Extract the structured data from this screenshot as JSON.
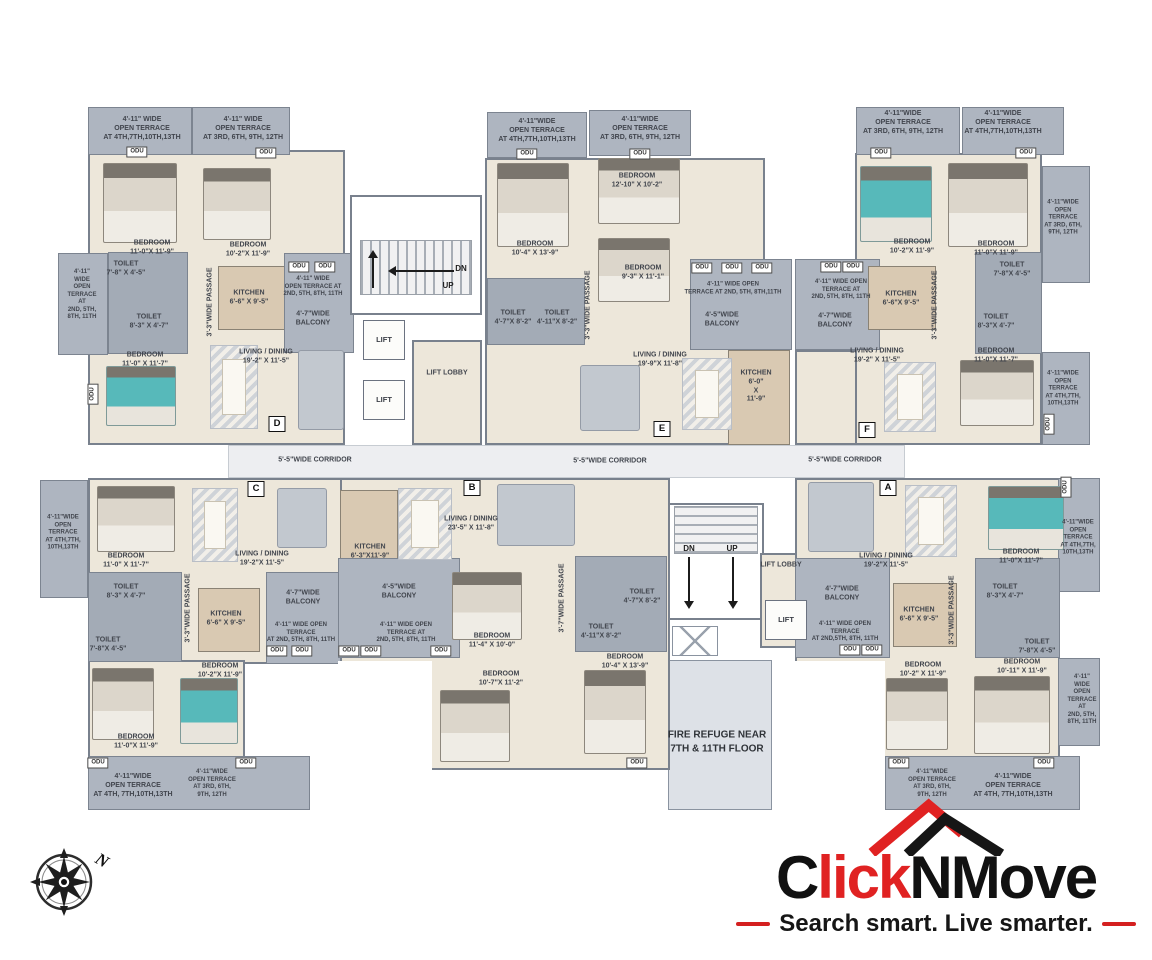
{
  "brand": {
    "part1": "C",
    "part2": "lick",
    "part3": "NMove",
    "tagline": "Search smart. Live smarter.",
    "accent_red": "#e02222",
    "ink_black": "#161616"
  },
  "compass": {
    "north_label": "N"
  },
  "plan": {
    "units": [
      "A",
      "B",
      "C",
      "D",
      "E",
      "F"
    ],
    "labels": [
      {
        "t": "4'-11\" WIDE\nOPEN TERRACE\nAT 4TH,7TH,10TH,13TH",
        "x": 142,
        "y": 129
      },
      {
        "t": "4'-11\" WIDE\nOPEN TERRACE\nAT 3RD, 6TH, 9TH, 12TH",
        "x": 243,
        "y": 129
      },
      {
        "t": "ODU",
        "x": 137,
        "y": 152,
        "c": "odu",
        "n": "odu-label"
      },
      {
        "t": "ODU",
        "x": 266,
        "y": 153,
        "c": "odu",
        "n": "odu-label"
      },
      {
        "t": "BEDROOM\n11'-0\"X 11'-9\"",
        "x": 152,
        "y": 248
      },
      {
        "t": "BEDROOM\n10'-2\"X 11'-9\"",
        "x": 248,
        "y": 250
      },
      {
        "t": "4'-11\"\nWIDE\nOPEN\nTERRACE\nAT\n2ND, 5TH,\n8TH, 11TH",
        "x": 82,
        "y": 295,
        "s": 6
      },
      {
        "t": "TOILET\n7'-8\" X 4'-5\"",
        "x": 126,
        "y": 269
      },
      {
        "t": "TOILET\n8'-3\" X 4'-7\"",
        "x": 149,
        "y": 322
      },
      {
        "t": "KITCHEN\n6'-6\" X 9'-5\"",
        "x": 249,
        "y": 298
      },
      {
        "t": "3'-3\"WIDE PASSAGE",
        "x": 211,
        "y": 302,
        "r": -90
      },
      {
        "t": "ODU",
        "x": 299,
        "y": 267,
        "c": "odu",
        "n": "odu-label"
      },
      {
        "t": "ODU",
        "x": 325,
        "y": 267,
        "c": "odu",
        "n": "odu-label"
      },
      {
        "t": "4'-11\" WIDE\nOPEN TERRACE AT\n2ND, 5TH, 8TH, 11TH",
        "x": 313,
        "y": 287,
        "s": 6
      },
      {
        "t": "4'-7\"WIDE\nBALCONY",
        "x": 313,
        "y": 319
      },
      {
        "t": "ODU",
        "x": 93,
        "y": 394,
        "c": "odu",
        "r": -90,
        "n": "odu-label"
      },
      {
        "t": "LIVING / DINING\n19'-2\" X 11'-5\"",
        "x": 266,
        "y": 357
      },
      {
        "t": "BEDROOM\n11'-0\" X 11'-7\"",
        "x": 145,
        "y": 360
      },
      {
        "t": "D",
        "x": 277,
        "y": 424,
        "c": "unitbox",
        "n": "unit-label-d"
      },
      {
        "t": "DN",
        "x": 461,
        "y": 269,
        "c": "dir",
        "n": "stairs-dn-label"
      },
      {
        "t": "UP",
        "x": 448,
        "y": 286,
        "c": "dir",
        "n": "stairs-up-label"
      },
      {
        "t": "LIFT",
        "x": 384,
        "y": 340,
        "c": "liftbox",
        "n": "lift-label"
      },
      {
        "t": "LIFT",
        "x": 384,
        "y": 400,
        "c": "liftbox",
        "n": "lift-label"
      },
      {
        "t": "LIFT LOBBY",
        "x": 447,
        "y": 374,
        "n": "lift-lobby-label"
      },
      {
        "t": "4'-11\"WIDE\nOPEN TERRACE\nAT 4TH,7TH,10TH,13TH",
        "x": 537,
        "y": 131
      },
      {
        "t": "ODU",
        "x": 527,
        "y": 154,
        "c": "odu",
        "n": "odu-label"
      },
      {
        "t": "4'-11\"WIDE\nOPEN TERRACE\nAT 3RD, 6TH, 9TH, 12TH",
        "x": 640,
        "y": 129
      },
      {
        "t": "ODU",
        "x": 640,
        "y": 154,
        "c": "odu",
        "n": "odu-label"
      },
      {
        "t": "BEDROOM\n12'-10\" X 10'-2\"",
        "x": 637,
        "y": 181
      },
      {
        "t": "BEDROOM\n10'-4\" X 13'-9\"",
        "x": 535,
        "y": 249
      },
      {
        "t": "BEDROOM\n9'-3\" X 11'-1\"",
        "x": 643,
        "y": 273
      },
      {
        "t": "TOILET\n4'-7\"X 8'-2\"",
        "x": 513,
        "y": 318
      },
      {
        "t": "TOILET\n4'-11\"X 8'-2\"",
        "x": 557,
        "y": 318
      },
      {
        "t": "3'-3\"WIDE PASSAGE",
        "x": 589,
        "y": 305,
        "r": -90
      },
      {
        "t": "ODU",
        "x": 702,
        "y": 268,
        "c": "odu",
        "n": "odu-label"
      },
      {
        "t": "ODU",
        "x": 732,
        "y": 268,
        "c": "odu",
        "n": "odu-label"
      },
      {
        "t": "ODU",
        "x": 762,
        "y": 268,
        "c": "odu",
        "n": "odu-label"
      },
      {
        "t": "4'-11\" WIDE OPEN\nTERRACE AT 2ND, 5TH, 8TH,11TH",
        "x": 733,
        "y": 289,
        "s": 6
      },
      {
        "t": "4'-5\"WIDE\nBALCONY",
        "x": 722,
        "y": 320
      },
      {
        "t": "KITCHEN\n6'-0\"\nX\n11'-9\"",
        "x": 756,
        "y": 387
      },
      {
        "t": "LIVING / DINING\n19'-9\"X 11'-8\"",
        "x": 660,
        "y": 360
      },
      {
        "t": "E",
        "x": 662,
        "y": 429,
        "c": "unitbox",
        "n": "unit-label-e"
      },
      {
        "t": "4'-11\"WIDE\nOPEN TERRACE\nAT 3RD, 6TH, 9TH, 12TH",
        "x": 903,
        "y": 123
      },
      {
        "t": "4'-11\"WIDE\nOPEN TERRACE\nAT 4TH,7TH,10TH,13TH",
        "x": 1003,
        "y": 123
      },
      {
        "t": "ODU",
        "x": 881,
        "y": 153,
        "c": "odu",
        "n": "odu-label"
      },
      {
        "t": "ODU",
        "x": 1026,
        "y": 153,
        "c": "odu",
        "n": "odu-label"
      },
      {
        "t": "BEDROOM\n10'-2\"X 11'-9\"",
        "x": 912,
        "y": 247
      },
      {
        "t": "BEDROOM\n11'-0\"X 11'-9\"",
        "x": 996,
        "y": 249
      },
      {
        "t": "4'-11\"WIDE\nOPEN\nTERRACE\nAT 3RD, 6TH,\n9TH, 12TH",
        "x": 1063,
        "y": 218,
        "s": 6
      },
      {
        "t": "ODU",
        "x": 831,
        "y": 267,
        "c": "odu",
        "n": "odu-label"
      },
      {
        "t": "ODU",
        "x": 853,
        "y": 267,
        "c": "odu",
        "n": "odu-label"
      },
      {
        "t": "4'-11\" WIDE OPEN\nTERRACE AT\n2ND, 5TH, 8TH, 11TH",
        "x": 841,
        "y": 290,
        "s": 6
      },
      {
        "t": "4'-7\"WIDE\nBALCONY",
        "x": 835,
        "y": 321
      },
      {
        "t": "KITCHEN\n6'-6\"X 9'-5\"",
        "x": 901,
        "y": 299
      },
      {
        "t": "TOILET\n7'-8\"X 4'-5\"",
        "x": 1012,
        "y": 270
      },
      {
        "t": "TOILET\n8'-3\"X 4'-7\"",
        "x": 996,
        "y": 322
      },
      {
        "t": "3'-3\"WIDE PASSAGE",
        "x": 936,
        "y": 305,
        "r": -90
      },
      {
        "t": "LIVING / DINING\n19'-2\" X 11'-5\"",
        "x": 877,
        "y": 356
      },
      {
        "t": "BEDROOM\n11'-0\"X 11'-7\"",
        "x": 996,
        "y": 356
      },
      {
        "t": "4'-11\"WIDE\nOPEN\nTERRACE\nAT 4TH,7TH,\n10TH,13TH",
        "x": 1063,
        "y": 389,
        "s": 6
      },
      {
        "t": "ODU",
        "x": 1049,
        "y": 424,
        "c": "odu",
        "r": -90,
        "n": "odu-label"
      },
      {
        "t": "F",
        "x": 867,
        "y": 430,
        "c": "unitbox",
        "n": "unit-label-f"
      },
      {
        "t": "5'-5\"WIDE CORRIDOR",
        "x": 315,
        "y": 461,
        "n": "corridor-label"
      },
      {
        "t": "5'-5\"WIDE CORRIDOR",
        "x": 610,
        "y": 462,
        "n": "corridor-label"
      },
      {
        "t": "5'-5\"WIDE CORRIDOR",
        "x": 845,
        "y": 461,
        "n": "corridor-label"
      },
      {
        "t": "DN",
        "x": 689,
        "y": 549,
        "c": "dir",
        "n": "stairs-dn-label"
      },
      {
        "t": "UP",
        "x": 732,
        "y": 549,
        "c": "dir",
        "n": "stairs-up-label"
      },
      {
        "t": "LIFT LOBBY",
        "x": 781,
        "y": 566,
        "n": "lift-lobby-label"
      },
      {
        "t": "LIFT",
        "x": 786,
        "y": 620,
        "c": "liftbox",
        "n": "lift-label"
      },
      {
        "t": "FIRE REFUGE NEAR\n7TH & 11TH FLOOR",
        "x": 717,
        "y": 742,
        "c": "fire",
        "n": "fire-refuge-label"
      },
      {
        "t": "C",
        "x": 256,
        "y": 489,
        "c": "unitbox",
        "n": "unit-label-c"
      },
      {
        "t": "4'-11\"WIDE\nOPEN\nTERRACE\nAT 4TH,7TH,\n10TH,13TH",
        "x": 63,
        "y": 533,
        "s": 6
      },
      {
        "t": "BEDROOM\n11'-0\" X 11'-7\"",
        "x": 126,
        "y": 561
      },
      {
        "t": "LIVING / DINING\n19'-2\"X 11'-5\"",
        "x": 262,
        "y": 559
      },
      {
        "t": "TOILET\n8'-3\" X 4'-7\"",
        "x": 126,
        "y": 592
      },
      {
        "t": "TOILET\n7'-8\"X 4'-5\"",
        "x": 108,
        "y": 645
      },
      {
        "t": "3'-3\"WIDE PASSAGE",
        "x": 189,
        "y": 608,
        "r": -90
      },
      {
        "t": "KITCHEN\n6'-6\" X 9'-5\"",
        "x": 226,
        "y": 619
      },
      {
        "t": "4'-7\"WIDE\nBALCONY",
        "x": 303,
        "y": 598
      },
      {
        "t": "4'-11\" WIDE OPEN\nTERRACE\nAT 2ND, 5TH, 8TH, 11TH",
        "x": 301,
        "y": 633,
        "s": 6
      },
      {
        "t": "ODU",
        "x": 277,
        "y": 651,
        "c": "odu",
        "n": "odu-label"
      },
      {
        "t": "ODU",
        "x": 302,
        "y": 651,
        "c": "odu",
        "n": "odu-label"
      },
      {
        "t": "BEDROOM\n10'-2\"X 11'-9\"",
        "x": 220,
        "y": 671
      },
      {
        "t": "BEDROOM\n11'-0\"X 11'-9\"",
        "x": 136,
        "y": 742
      },
      {
        "t": "ODU",
        "x": 98,
        "y": 763,
        "c": "odu",
        "n": "odu-label"
      },
      {
        "t": "ODU",
        "x": 246,
        "y": 763,
        "c": "odu",
        "n": "odu-label"
      },
      {
        "t": "4'-11\"WIDE\nOPEN TERRACE\nAT 4TH, 7TH,10TH,13TH",
        "x": 133,
        "y": 786
      },
      {
        "t": "4'-11\"WIDE\nOPEN TERRACE\nAT 3RD, 6TH,\n9TH, 12TH",
        "x": 212,
        "y": 784,
        "s": 6
      },
      {
        "t": "B",
        "x": 472,
        "y": 488,
        "c": "unitbox",
        "n": "unit-label-b"
      },
      {
        "t": "LIVING / DINING\n23'-5\" X 11'-8\"",
        "x": 471,
        "y": 524
      },
      {
        "t": "KITCHEN\n6'-3\"X11'-9\"",
        "x": 370,
        "y": 552
      },
      {
        "t": "4'-5\"WIDE\nBALCONY",
        "x": 399,
        "y": 592
      },
      {
        "t": "4'-11\" WIDE OPEN\nTERRACE AT\n2ND, 5TH, 8TH, 11TH",
        "x": 406,
        "y": 633,
        "s": 6
      },
      {
        "t": "ODU",
        "x": 349,
        "y": 651,
        "c": "odu",
        "n": "odu-label"
      },
      {
        "t": "ODU",
        "x": 371,
        "y": 651,
        "c": "odu",
        "n": "odu-label"
      },
      {
        "t": "ODU",
        "x": 441,
        "y": 651,
        "c": "odu",
        "n": "odu-label"
      },
      {
        "t": "BEDROOM\n11'-4\" X 10'-0\"",
        "x": 492,
        "y": 641
      },
      {
        "t": "BEDROOM\n10'-7\"X 11'-2\"",
        "x": 501,
        "y": 679
      },
      {
        "t": "3'-7\"WIDE PASSAGE",
        "x": 563,
        "y": 598,
        "r": -90
      },
      {
        "t": "TOILET\n4'-7\"X 8'-2\"",
        "x": 642,
        "y": 597
      },
      {
        "t": "TOILET\n4'-11\"X 8'-2\"",
        "x": 601,
        "y": 632
      },
      {
        "t": "BEDROOM\n10'-4\" X 13'-9\"",
        "x": 625,
        "y": 662
      },
      {
        "t": "ODU",
        "x": 637,
        "y": 763,
        "c": "odu",
        "n": "odu-label"
      },
      {
        "t": "A",
        "x": 888,
        "y": 488,
        "c": "unitbox",
        "n": "unit-label-a"
      },
      {
        "t": "LIVING / DINING\n19'-2\"X 11'-5\"",
        "x": 886,
        "y": 561
      },
      {
        "t": "BEDROOM\n11'-0\"X 11'-7\"",
        "x": 1021,
        "y": 557
      },
      {
        "t": "4'-11\"WIDE\nOPEN\nTERRACE\nAT 4TH,7TH,\n10TH,13TH",
        "x": 1078,
        "y": 538,
        "s": 6
      },
      {
        "t": "ODU",
        "x": 1066,
        "y": 487,
        "c": "odu",
        "r": -90,
        "n": "odu-label"
      },
      {
        "t": "4'-7\"WIDE\nBALCONY",
        "x": 842,
        "y": 594
      },
      {
        "t": "4'-11\" WIDE OPEN\nTERRACE\nAT 2ND,5TH, 8TH, 11TH",
        "x": 845,
        "y": 632,
        "s": 6
      },
      {
        "t": "ODU",
        "x": 850,
        "y": 650,
        "c": "odu",
        "n": "odu-label"
      },
      {
        "t": "ODU",
        "x": 872,
        "y": 650,
        "c": "odu",
        "n": "odu-label"
      },
      {
        "t": "KITCHEN\n6'-6\" X 9'-5\"",
        "x": 919,
        "y": 615
      },
      {
        "t": "TOILET\n8'-3\"X 4'-7\"",
        "x": 1005,
        "y": 592
      },
      {
        "t": "TOILET\n7'-8\"X 4'-5\"",
        "x": 1037,
        "y": 647
      },
      {
        "t": "3'-3\"WIDE PASSAGE",
        "x": 953,
        "y": 610,
        "r": -90
      },
      {
        "t": "BEDROOM\n10'-2\" X 11'-9\"",
        "x": 923,
        "y": 670
      },
      {
        "t": "BEDROOM\n10'-11\" X 11'-9\"",
        "x": 1022,
        "y": 667
      },
      {
        "t": "4'-11\"\nWIDE\nOPEN\nTERRACE\nAT\n2ND, 5TH,\n8TH, 11TH",
        "x": 1082,
        "y": 700,
        "s": 6
      },
      {
        "t": "ODU",
        "x": 899,
        "y": 763,
        "c": "odu",
        "n": "odu-label"
      },
      {
        "t": "ODU",
        "x": 1044,
        "y": 763,
        "c": "odu",
        "n": "odu-label"
      },
      {
        "t": "4'-11\"WIDE\nOPEN TERRACE\nAT 3RD, 6TH,\n9TH, 12TH",
        "x": 932,
        "y": 784,
        "s": 6
      },
      {
        "t": "4'-11\"WIDE\nOPEN TERRACE\nAT 4TH, 7TH,10TH,13TH",
        "x": 1013,
        "y": 786
      }
    ]
  }
}
